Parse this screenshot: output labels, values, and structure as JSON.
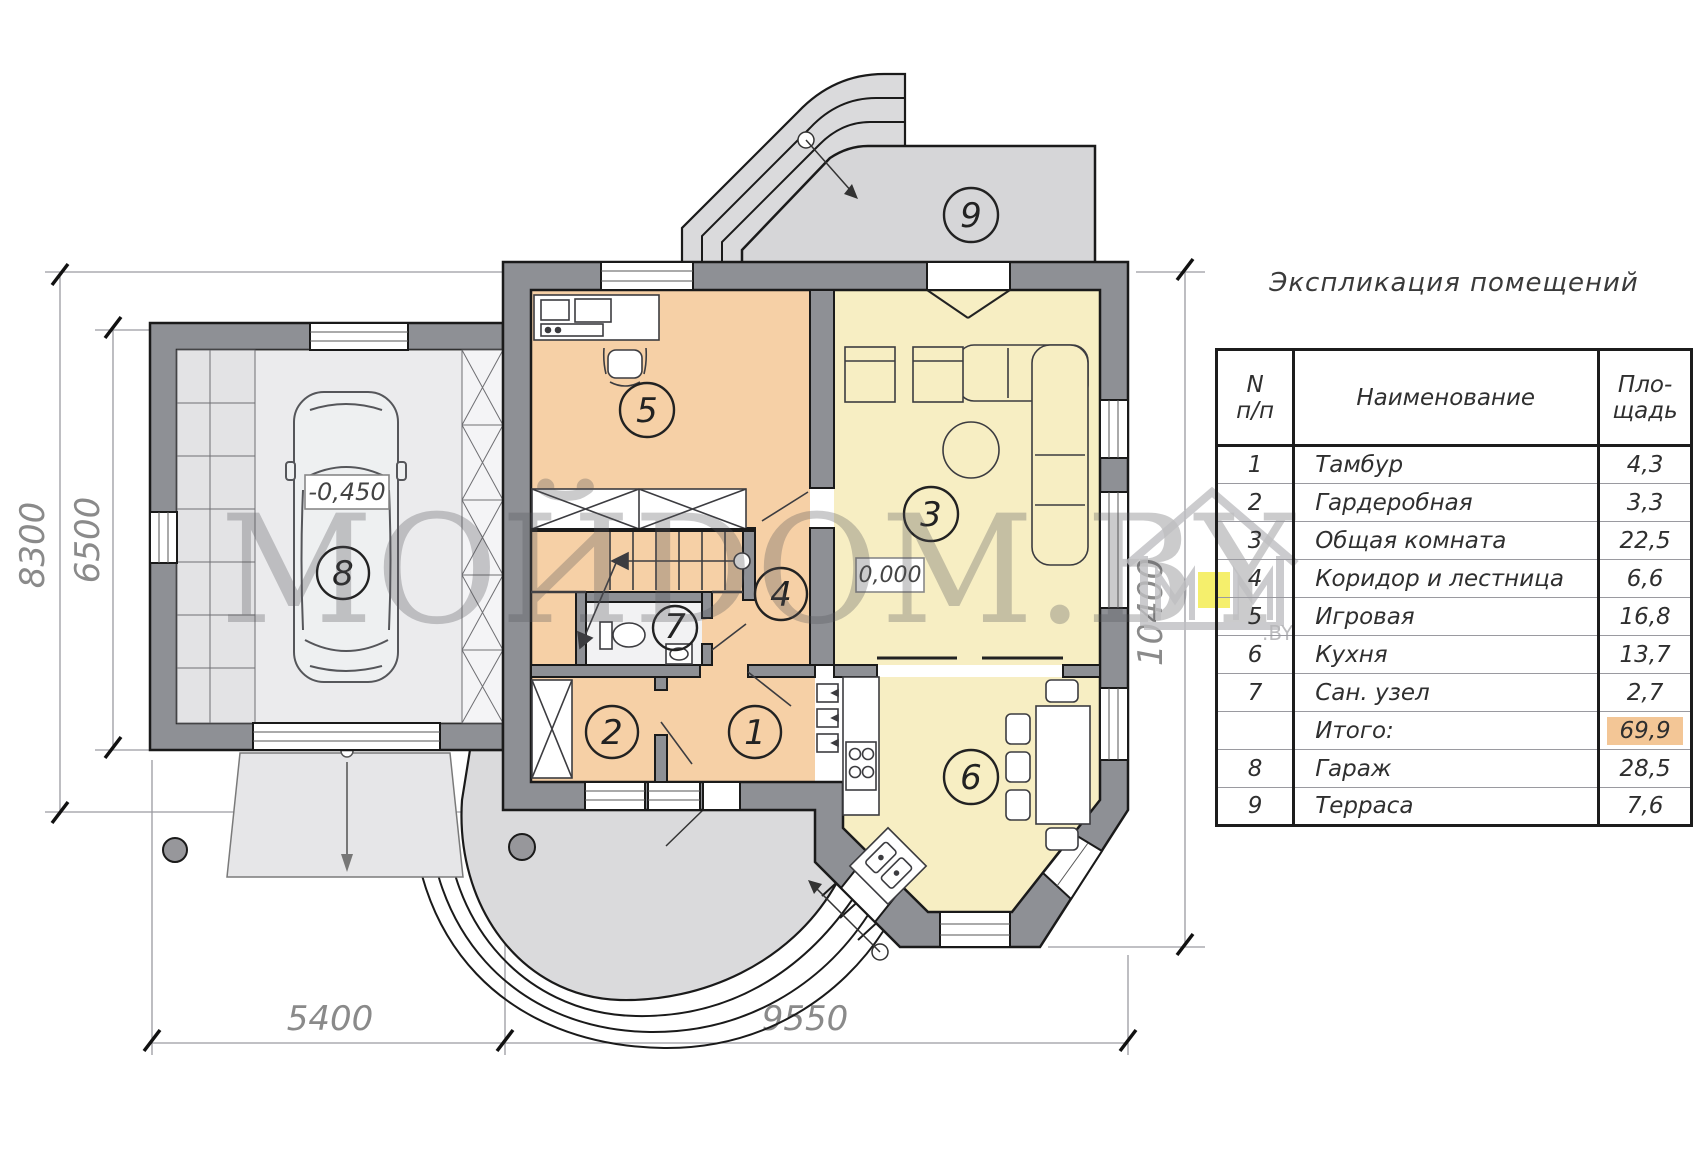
{
  "legend": {
    "title": "Экспликация помещений",
    "columns": {
      "n_line1": "N",
      "n_line2": "п/п",
      "name": "Наименование",
      "area_line1": "Пло-",
      "area_line2": "щадь"
    },
    "rows": [
      {
        "n": "1",
        "name": "Тамбур",
        "area": "4,3"
      },
      {
        "n": "2",
        "name": "Гардеробная",
        "area": "3,3"
      },
      {
        "n": "3",
        "name": "Общая комната",
        "area": "22,5"
      },
      {
        "n": "4",
        "name": "Коридор и лестница",
        "area": "6,6"
      },
      {
        "n": "5",
        "name": "Игровая",
        "area": "16,8"
      },
      {
        "n": "6",
        "name": "Кухня",
        "area": "13,7"
      },
      {
        "n": "7",
        "name": "Сан. узел",
        "area": "2,7"
      },
      {
        "n": "",
        "name": "Итого:",
        "area": "69,9"
      },
      {
        "n": "8",
        "name": "Гараж",
        "area": "28,5"
      },
      {
        "n": "9",
        "name": "Терраса",
        "area": "7,6"
      }
    ],
    "total_row_highlight_color": "#f3c696"
  },
  "plan": {
    "dimensions": {
      "left_outer": "8300",
      "left_inner": "6500",
      "bottom_left": "5400",
      "bottom_right": "9550",
      "right": "10400"
    },
    "elevations": {
      "garage": "-0,450",
      "ground_floor": "0,000"
    },
    "rooms": [
      {
        "number": "1"
      },
      {
        "number": "2"
      },
      {
        "number": "3"
      },
      {
        "number": "4"
      },
      {
        "number": "5"
      },
      {
        "number": "6"
      },
      {
        "number": "7"
      },
      {
        "number": "8"
      },
      {
        "number": "9"
      }
    ]
  },
  "watermark": {
    "text": "МОЙDOM.BY",
    "logo_by": ".BY"
  },
  "colors": {
    "room_warm": "#f6d0a6",
    "room_yellow": "#f7eec3",
    "wall": "#8e9095",
    "outdoor": "#dadadc",
    "highlight": "#f3c696"
  }
}
